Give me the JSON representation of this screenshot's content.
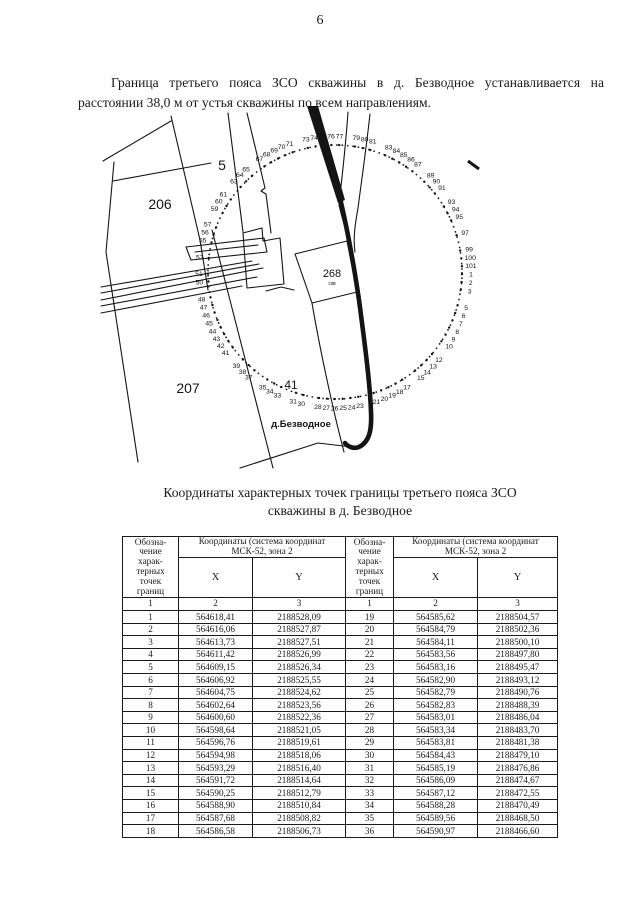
{
  "page": {
    "number": "6"
  },
  "intro_paragraph": "Граница третьего пояса ЗСО скважины в д. Безводное устанавливается на расстоянии 38,0 м от устья скважины по всем направлениям.",
  "map": {
    "circle": {
      "cx": 335,
      "cy": 272,
      "r": 127
    },
    "label_radius": 136,
    "start_angle": 1,
    "total_points": 101,
    "point_labels": [
      1,
      2,
      3,
      5,
      6,
      7,
      8,
      9,
      10,
      12,
      13,
      14,
      15,
      17,
      18,
      19,
      20,
      21,
      23,
      24,
      25,
      26,
      27,
      28,
      30,
      31,
      33,
      34,
      35,
      37,
      38,
      39,
      41,
      42,
      43,
      44,
      45,
      46,
      47,
      48,
      50,
      51,
      53,
      55,
      56,
      57,
      59,
      60,
      61,
      63,
      64,
      65,
      67,
      68,
      69,
      70,
      71,
      73,
      74,
      75,
      76,
      77,
      79,
      80,
      81,
      83,
      84,
      85,
      86,
      87,
      89,
      90,
      91,
      93,
      94,
      95,
      97,
      99,
      100,
      101
    ],
    "parcel_labels": [
      {
        "text": "206",
        "x": 160,
        "y": 209,
        "size": 14
      },
      {
        "text": "5",
        "x": 222,
        "y": 170,
        "size": 14
      },
      {
        "text": "207",
        "x": 188,
        "y": 393,
        "size": 14
      },
      {
        "text": "41",
        "x": 291,
        "y": 389,
        "size": 12
      },
      {
        "text": "268",
        "x": 332,
        "y": 277,
        "size": 11
      },
      {
        "text": "скв",
        "x": 332,
        "y": 285,
        "size": 5
      }
    ],
    "village_label": {
      "text": "д.Безводное",
      "x": 301,
      "y": 427,
      "size": 9.5
    }
  },
  "table": {
    "title_line1": "Координаты характерных точек границы третьего пояса ЗСО",
    "title_line2": "скважины в д. Безводное",
    "header": {
      "designation": "Обозна-\nчение\nхарак-\nтерных\nточек\nграниц",
      "coords": "Координаты (система координат\nМСК-52, зона 2",
      "x": "X",
      "y": "Y",
      "num1": "1",
      "num2": "2",
      "num3": "3"
    },
    "rows_left": [
      [
        "1",
        "564618,41",
        "2188528,09"
      ],
      [
        "2",
        "564616,06",
        "2188527,87"
      ],
      [
        "3",
        "564613,73",
        "2188527,51"
      ],
      [
        "4",
        "564611,42",
        "2188526,99"
      ],
      [
        "5",
        "564609,15",
        "2188526,34"
      ],
      [
        "6",
        "564606,92",
        "2188525,55"
      ],
      [
        "7",
        "564604,75",
        "2188524,62"
      ],
      [
        "8",
        "564602,64",
        "2188523,56"
      ],
      [
        "9",
        "564600,60",
        "2188522,36"
      ],
      [
        "10",
        "564598,64",
        "2188521,05"
      ],
      [
        "11",
        "564596,76",
        "2188519,61"
      ],
      [
        "12",
        "564594,98",
        "2188518,06"
      ],
      [
        "13",
        "564593,29",
        "2188516,40"
      ],
      [
        "14",
        "564591,72",
        "2188514,64"
      ],
      [
        "15",
        "564590,25",
        "2188512,79"
      ],
      [
        "16",
        "564588,90",
        "2188510,84"
      ],
      [
        "17",
        "564587,68",
        "2188508,82"
      ],
      [
        "18",
        "564586,58",
        "2188506,73"
      ]
    ],
    "rows_right": [
      [
        "19",
        "564585,62",
        "2188504,57"
      ],
      [
        "20",
        "564584,79",
        "2188502,36"
      ],
      [
        "21",
        "564584,11",
        "2188500,10"
      ],
      [
        "22",
        "564583,56",
        "2188497,80"
      ],
      [
        "23",
        "564583,16",
        "2188495,47"
      ],
      [
        "24",
        "564582,90",
        "2188493,12"
      ],
      [
        "25",
        "564582,79",
        "2188490,76"
      ],
      [
        "26",
        "564582,83",
        "2188488,39"
      ],
      [
        "27",
        "564583,01",
        "2188486,04"
      ],
      [
        "28",
        "564583,34",
        "2188483,70"
      ],
      [
        "29",
        "564583,81",
        "2188481,38"
      ],
      [
        "30",
        "564584,43",
        "2188479,10"
      ],
      [
        "31",
        "564585,19",
        "2188476,86"
      ],
      [
        "32",
        "564586,09",
        "2188474,67"
      ],
      [
        "33",
        "564587,12",
        "2188472,55"
      ],
      [
        "34",
        "564588,28",
        "2188470,49"
      ],
      [
        "35",
        "564589,56",
        "2188468,50"
      ],
      [
        "36",
        "564590,97",
        "2188466,60"
      ]
    ]
  },
  "colors": {
    "ink": "#141414",
    "paper": "#ffffff"
  }
}
